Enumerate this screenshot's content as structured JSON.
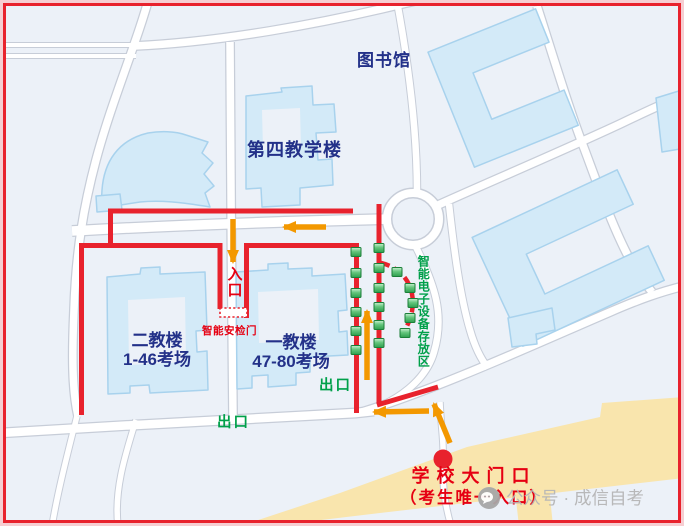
{
  "labels": {
    "library": "图书馆",
    "teaching_building_4": "第四教学楼",
    "teaching_building_2": {
      "name": "二教楼",
      "rooms": "1-46考场"
    },
    "teaching_building_1": {
      "name": "一教楼",
      "rooms": "47-80考场"
    },
    "entrance": "入口",
    "security_gate": "智能安检门",
    "device_storage_area": "智能电子设备存放区",
    "exit_near_building1": "出口",
    "exit_south": "出口",
    "school_gate": {
      "line1": "学校大门口",
      "line2": "（考生唯一入口）"
    }
  },
  "watermark": {
    "text": "公众号 · 成信自考",
    "icon": "wechat-official-account-icon"
  },
  "colors": {
    "route_red": "#e8222d",
    "arrow_orange": "#f39800",
    "marker_green": "#2e9e4e",
    "text_navy": "#233189",
    "text_red": "#e60012",
    "text_green": "#00a04a",
    "building_fill": "#d3eaf8",
    "building_edge": "#a8d2ed",
    "main_street_yellow": "#f9e5ad",
    "map_background": "#ecf1f8",
    "road_fill": "#ffffff",
    "road_casing": "#c7cdd8"
  }
}
